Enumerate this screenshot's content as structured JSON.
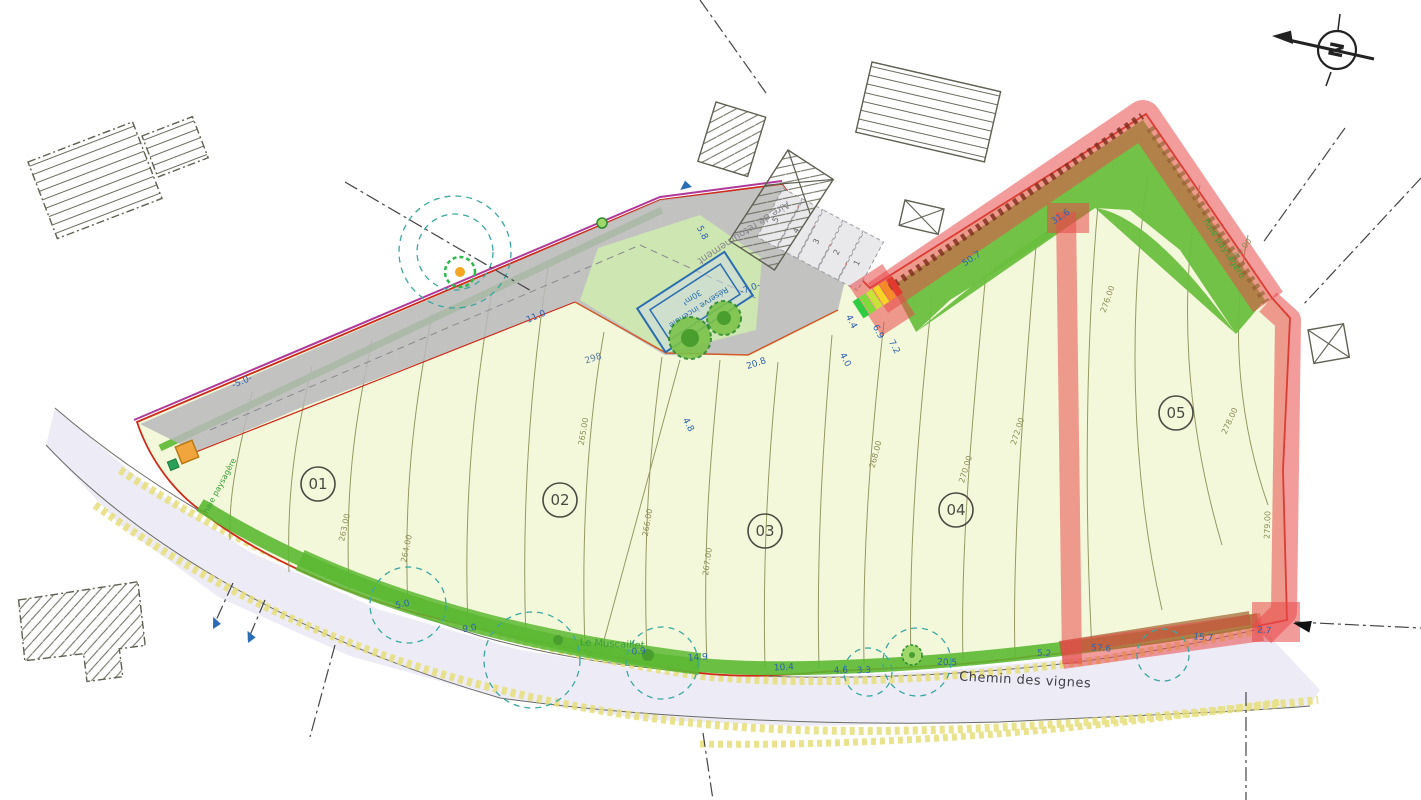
{
  "labels": {
    "road": "Chemin des vignes",
    "north": "N",
    "turnaround": "Aire de retournement",
    "fire_reserve_1": "Réserve incendie",
    "fire_reserve_2": "30m³",
    "stream": "Le Muscaillet",
    "hedge_left": "haie paysagère",
    "hedge_right": "haie paysagère",
    "parcel_number": "298"
  },
  "lots": [
    {
      "id": "01"
    },
    {
      "id": "02"
    },
    {
      "id": "03"
    },
    {
      "id": "04"
    },
    {
      "id": "05"
    }
  ],
  "stalls": [
    {
      "n": "1"
    },
    {
      "n": "2"
    },
    {
      "n": "3"
    },
    {
      "n": "4"
    },
    {
      "n": "5"
    }
  ],
  "dimensions": [
    {
      "text": "-5.0-"
    },
    {
      "text": "11.0"
    },
    {
      "text": "5.8"
    },
    {
      "text": "-7.0-"
    },
    {
      "text": "20.8"
    },
    {
      "text": "4.4"
    },
    {
      "text": "6.9"
    },
    {
      "text": "7.2"
    },
    {
      "text": "4.0"
    },
    {
      "text": "5.0"
    },
    {
      "text": "9.0"
    },
    {
      "text": "0.9"
    },
    {
      "text": "14.9"
    },
    {
      "text": "10.4"
    },
    {
      "text": "4.6"
    },
    {
      "text": "3.3"
    },
    {
      "text": "20.5"
    },
    {
      "text": "5.2"
    },
    {
      "text": "57.6"
    },
    {
      "text": "15.7"
    },
    {
      "text": "2.7"
    },
    {
      "text": "50.7"
    },
    {
      "text": "31.6"
    },
    {
      "text": "4.8"
    }
  ],
  "contour_labels": [
    {
      "text": "263.00"
    },
    {
      "text": "264.00"
    },
    {
      "text": "265.00"
    },
    {
      "text": "266.00"
    },
    {
      "text": "267.00"
    },
    {
      "text": "268.00"
    },
    {
      "text": "270.00"
    },
    {
      "text": "272.00"
    },
    {
      "text": "276.00"
    },
    {
      "text": "278.00"
    },
    {
      "text": "279.00"
    },
    {
      "text": "280.00"
    }
  ],
  "colors": {
    "parcel_fill": "#f4f8da",
    "green_strip": "#5cb832",
    "green_area": "#6abf3f",
    "red_overlay": "#e84a4a",
    "driveway_gray": "#b8b8bc",
    "road_fill": "#edecf6",
    "dimension_blue": "#2f62b0",
    "contour_olive": "#8a8f58",
    "boundary_red": "#cc2a1a",
    "boundary_purple": "#b03a9a",
    "ditch_yellow": "#e6df7a",
    "fire_blue": "#2a6db0",
    "canopy_teal": "#3aa7a0"
  }
}
